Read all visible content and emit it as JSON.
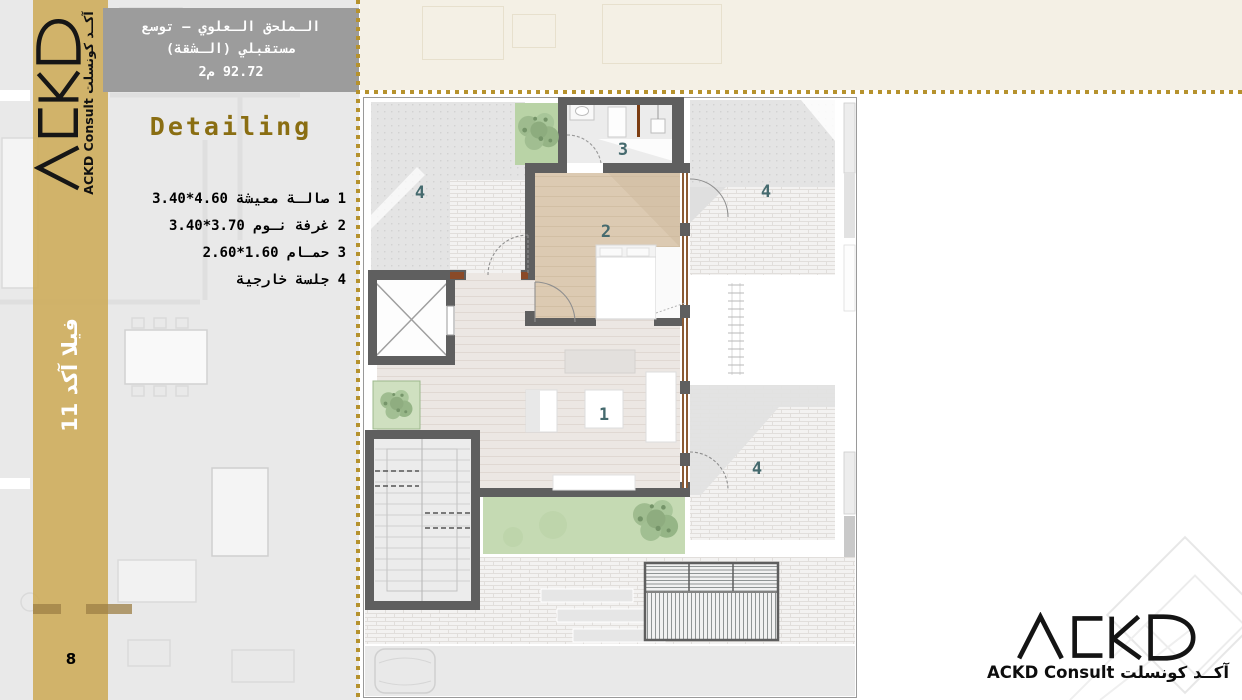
{
  "slide": {
    "page_number": "8",
    "section_title": "Detailing",
    "header": {
      "line1": "الـملحق الـعلوي – توسع",
      "line2": "مستقبلي (الـشقة)",
      "line3": "92.72 م2"
    },
    "sidebar": {
      "project_label": "فيلا آكد 11"
    },
    "brand": {
      "logo_text": "ACKD",
      "caption": "ACKD Consult آكــد كونسلت"
    },
    "legend": {
      "items": [
        {
          "label": "1 صالـة معيشة 4.60*3.40"
        },
        {
          "label": "2 غرفة نـوم 3.70*3.40"
        },
        {
          "label": "3 حمـام 1.60*2.60"
        },
        {
          "label": "4 جلسة خارجية"
        }
      ]
    },
    "plan": {
      "room_labels": [
        "1",
        "2",
        "3",
        "4",
        "4",
        "4"
      ],
      "rooms": [
        {
          "number": "1",
          "name": "صالة معيشة",
          "size": "4.60*3.40"
        },
        {
          "number": "2",
          "name": "غرفة نوم",
          "size": "3.70*3.40"
        },
        {
          "number": "3",
          "name": "حمام",
          "size": "1.60*2.60"
        },
        {
          "number": "4",
          "name": "جلسة خارجية",
          "size": ""
        }
      ],
      "area_label": "92.72 م2"
    },
    "colors": {
      "accent_gold": "#b6922d",
      "sidebar_gold": "#ceae5e",
      "header_gray": "#9c9c9c",
      "title_gold": "#8a6e12",
      "room_label": "#456a6e",
      "wall": "#5f5f5f",
      "bedroom_floor": "#dccab2",
      "lawn_green": "#c5dab3"
    }
  }
}
